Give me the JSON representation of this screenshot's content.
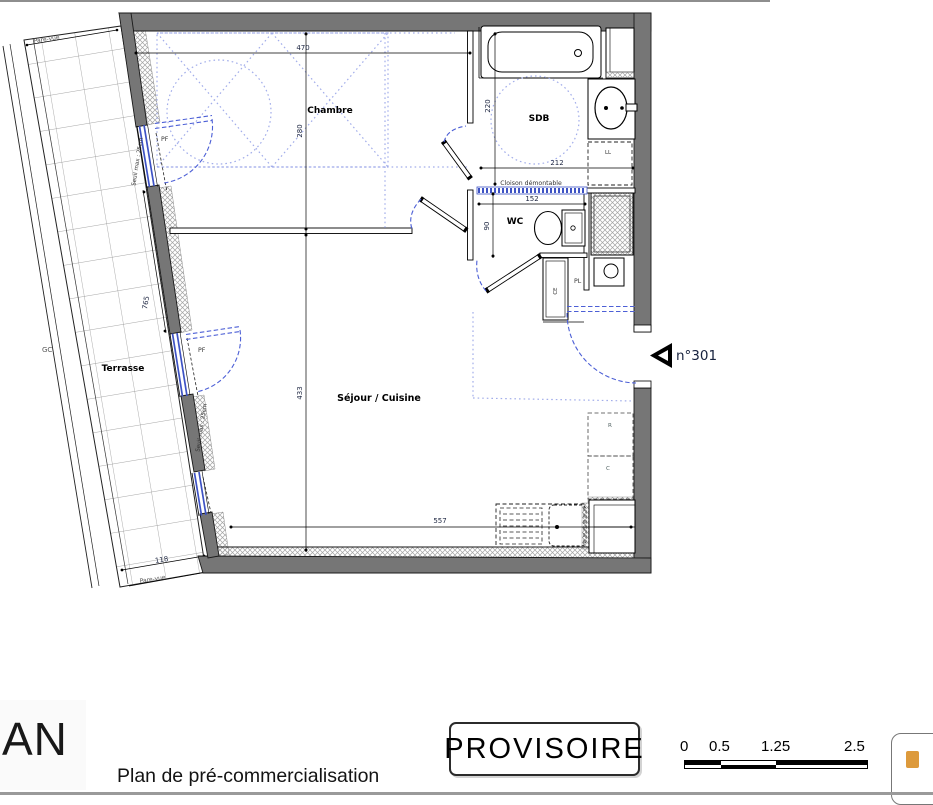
{
  "plan": {
    "rooms": {
      "chambre": "Chambre",
      "sdb": "SDB",
      "wc": "WC",
      "sejour": "Séjour / Cuisine",
      "terrasse": "Terrasse"
    },
    "annotations": {
      "unit_number": "n°301",
      "cloison": "Cloison démontable",
      "seuil_pf1": "Seuil max : 25cm",
      "seuil_pf2": "Seuil max : 25cm",
      "pf1": "PF",
      "pf2": "PF",
      "gc": "GC",
      "ll": "LL",
      "pl": "PL",
      "ce": "CE",
      "refrigerator": "R",
      "cooker": "C",
      "pare_vue_top": "Pare-vue",
      "pare_vue_bottom": "Pare-vue"
    },
    "dimensions_cm": {
      "chambre_width": "470",
      "chambre_depth": "280",
      "sdb_depth": "220",
      "sdb_width": "212",
      "wc_width": "152",
      "wc_depth": "90",
      "sejour_depth": "433",
      "sejour_width": "557",
      "terrasse_length": "765",
      "terrasse_width": "118"
    }
  },
  "footer": {
    "logo": "AN",
    "subtitle": "Plan de pré-commercialisation",
    "stamp": "PROVISOIRE",
    "scale_labels": [
      "0",
      "0.5",
      "1.25",
      "2.5"
    ]
  },
  "colors": {
    "wall_gray": "#767676",
    "window_blue": "#3d52c4",
    "door_arc_blue": "#4c5fd6",
    "guide_dotted_blue": "#a2adea"
  }
}
